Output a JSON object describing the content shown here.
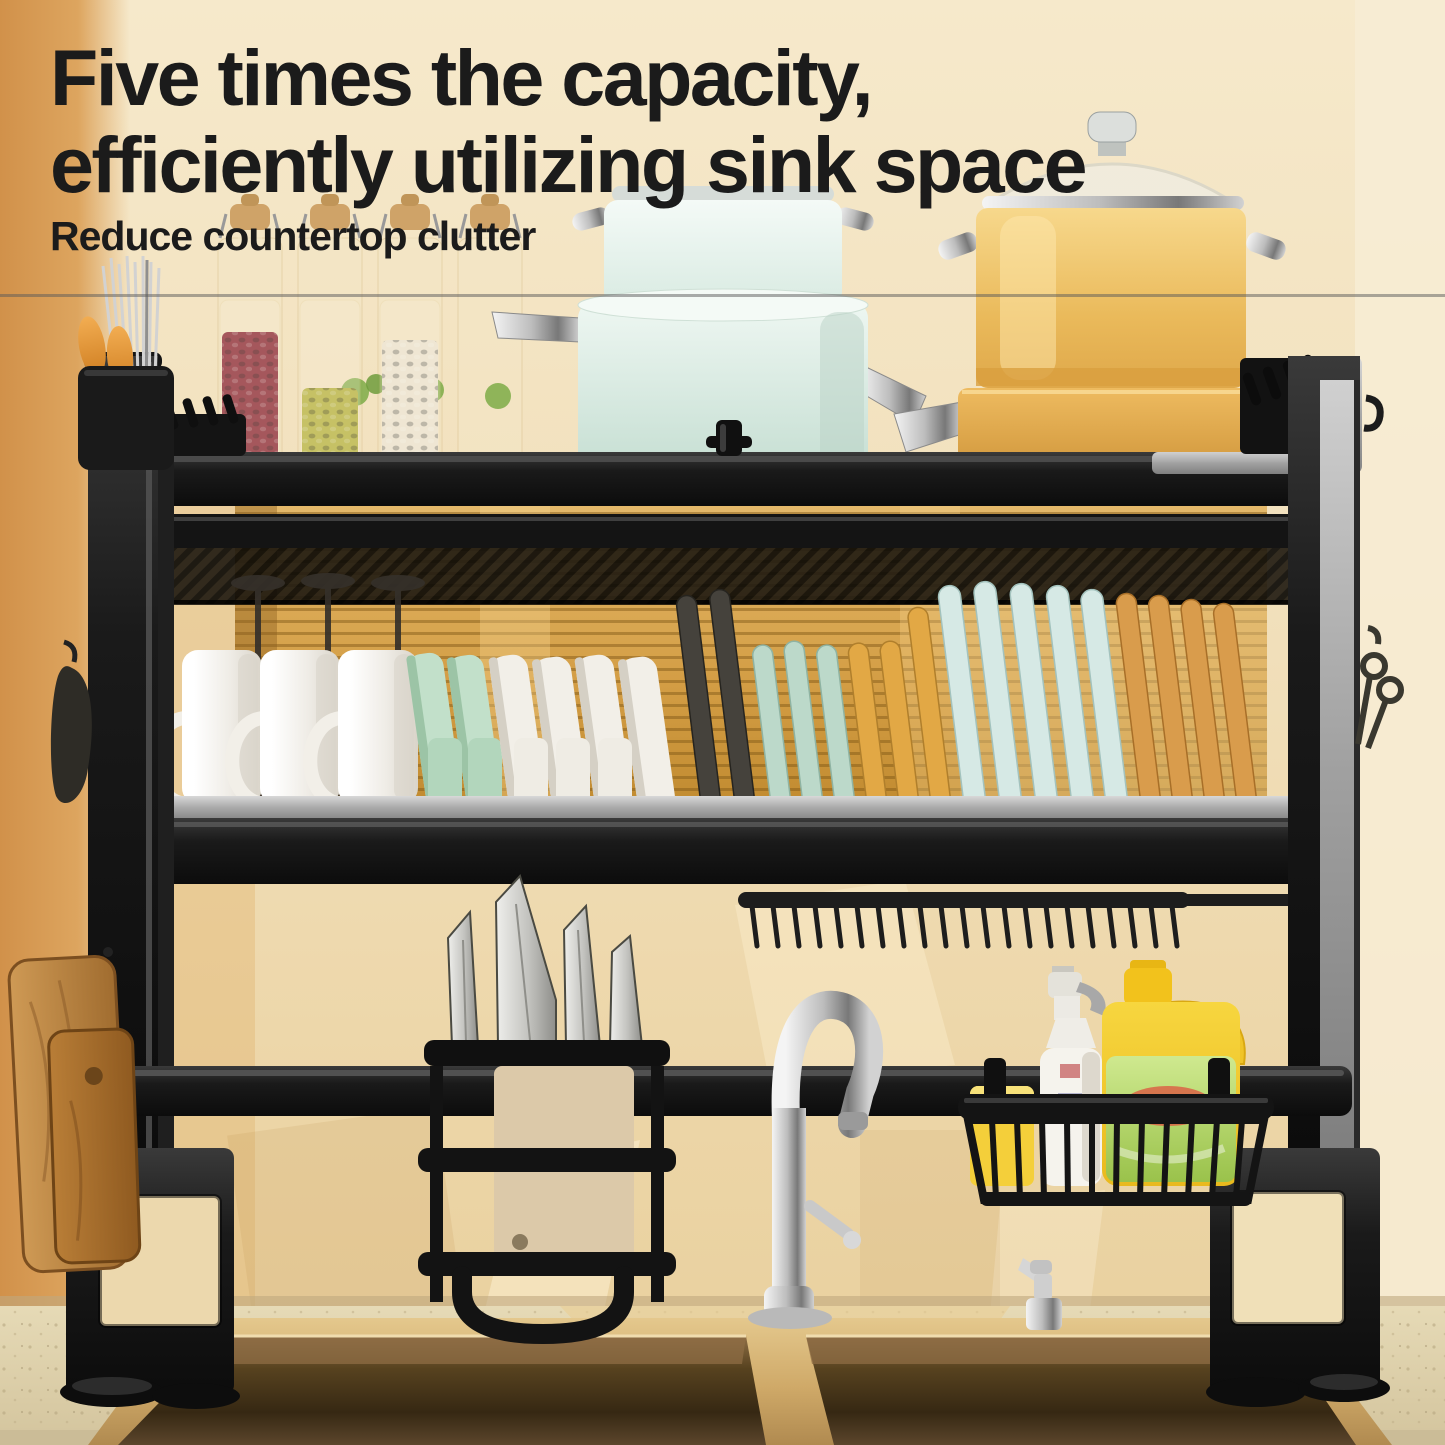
{
  "header": {
    "title_line1": "Five times the capacity,",
    "title_line2": "efficiently utilizing sink space",
    "subtitle": "Reduce countertop clutter",
    "text_color": "#1b1b1b"
  },
  "palette": {
    "wall": "#f2e2bf",
    "wall_left_band": "#dda55f",
    "mat_gold": "#d39d44",
    "rack_black": "#161616",
    "rail_silver": "#b5b5b5",
    "mint_pot": "#d9ece3",
    "yellow_pot": "#eec06a",
    "plate_dark": "#45423c",
    "plate_mint": "#bcd9ca",
    "plate_yellow": "#e2a845",
    "plate_blue": "#d6e9e5",
    "plate_tan": "#d99c4c",
    "mug_white": "#f4f1ea",
    "bowl_green": "#bfe0c6",
    "bowl_white": "#f0ede6",
    "wood_board": "#b97f3d",
    "sponge": "#f4cf3a",
    "jug_yellow": "#f0c428",
    "jug_label": "#a9d464",
    "jug_blob_red": "#e0483a",
    "spray_white": "#f5f3ed",
    "chrome": "#d8d8d8",
    "beans_red": "#8a2433",
    "beans_green": "#b5b23e",
    "beans_white": "#ece4d2",
    "sink_rim": "#cfae72",
    "sink_inner_dark": "#362813",
    "counter": "#dccfab",
    "knife_blade": "#d6d6d2",
    "cleaver_face": "#dcc9a9"
  },
  "scene_counts": {
    "wine_glasses": 3,
    "mugs": 3,
    "green_bowls": 2,
    "white_bowls": 4,
    "plates_dark": 2,
    "plates_mint": 3,
    "plates_yellow": 3,
    "plates_blue": 5,
    "plates_tan": 4,
    "knives": 4,
    "storage_jars": 4,
    "cutting_boards": 2
  }
}
